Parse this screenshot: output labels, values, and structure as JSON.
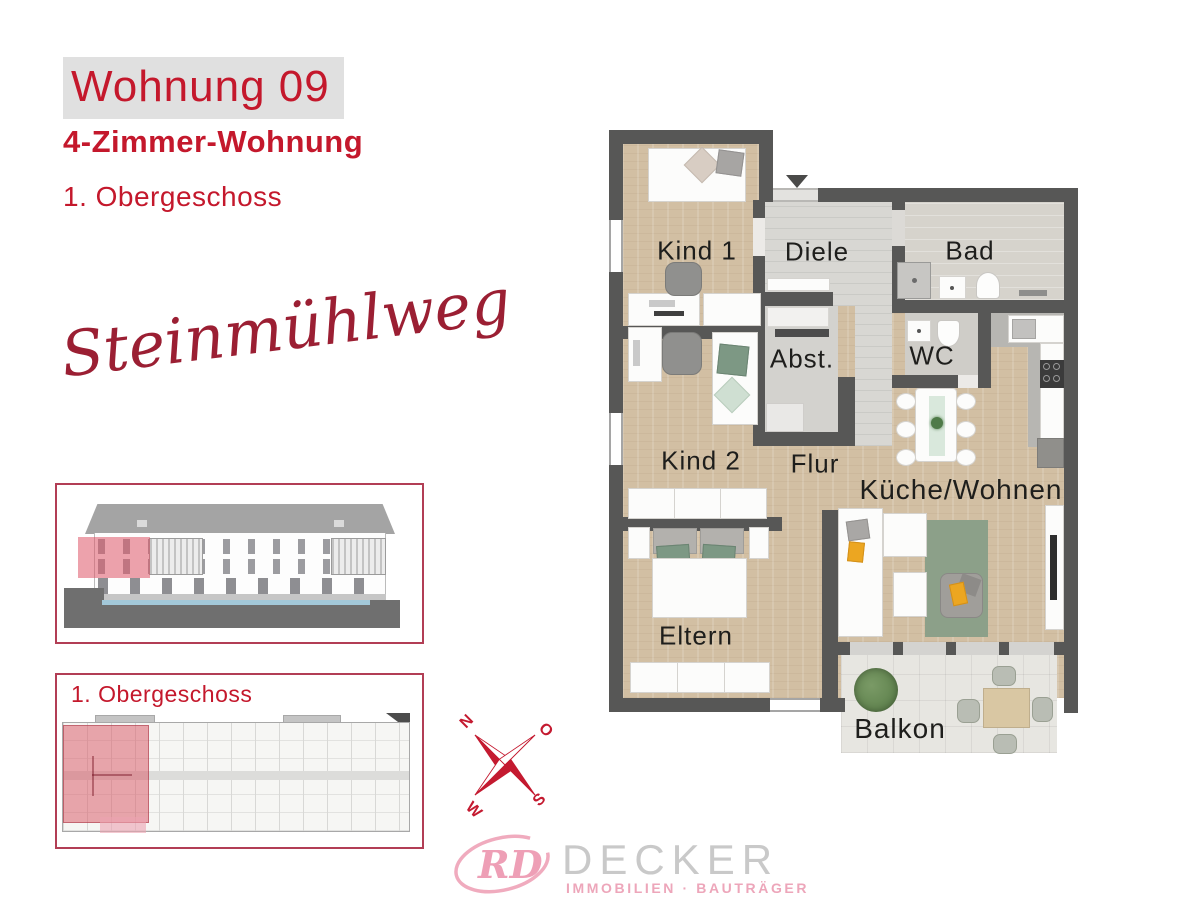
{
  "header": {
    "apartment_title": "Wohnung 09",
    "apartment_type": "4-Zimmer-Wohnung",
    "floor": "1. Obergeschoss"
  },
  "street_name": "Steinmühlweg",
  "overview_box": {
    "label": "1. Obergeschoss"
  },
  "compass": {
    "north": "N",
    "east": "O",
    "south": "S",
    "west": "W"
  },
  "floorplan": {
    "rooms": [
      {
        "id": "kind1",
        "label": "Kind 1"
      },
      {
        "id": "diele",
        "label": "Diele"
      },
      {
        "id": "bad",
        "label": "Bad"
      },
      {
        "id": "abst",
        "label": "Abst."
      },
      {
        "id": "wc",
        "label": "WC"
      },
      {
        "id": "kind2",
        "label": "Kind 2"
      },
      {
        "id": "flur",
        "label": "Flur"
      },
      {
        "id": "kueche_wohnen",
        "label": "Küche/Wohnen"
      },
      {
        "id": "eltern",
        "label": "Eltern"
      },
      {
        "id": "balkon",
        "label": "Balkon"
      }
    ]
  },
  "logo": {
    "monogram": "RD",
    "company": "DECKER",
    "tagline": "IMMOBILIEN · BAUTRÄGER"
  },
  "colors": {
    "accent_red": "#c4182c",
    "box_border_red": "#b23e55",
    "script_red": "#9b1f33",
    "wall_gray": "#575756",
    "wood_floor": "#d2bfa3",
    "tile_gray": "#d8d7d3",
    "highlight_pink": "#dd6073",
    "logo_pink": "#efa4b9",
    "logo_gray": "#c9c9c9"
  }
}
